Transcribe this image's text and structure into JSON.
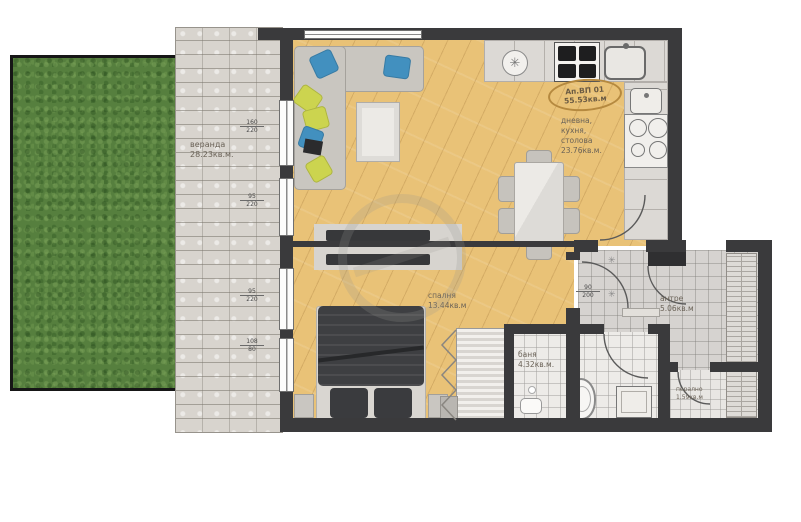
{
  "stamp": {
    "id": "Ап.ВП 01",
    "area": "55.53кв.м"
  },
  "rooms": {
    "veranda": {
      "name": "веранда",
      "area": "28.23кв.м."
    },
    "living": {
      "name1": "дневна,",
      "name2": "кухня,",
      "name3": "столова",
      "area": "23.76кв.м."
    },
    "bedroom": {
      "name": "спалня",
      "area": "13.44кв.м"
    },
    "bathroom": {
      "name": "баня",
      "area": "4.32кв.м."
    },
    "hallway": {
      "name": "антре",
      "area": "5.06кв.м"
    },
    "laundry": {
      "name": "перално",
      "area": "1.59кв.м"
    }
  },
  "dimensions": {
    "window1": {
      "top": "160",
      "bottom": "220"
    },
    "window2": {
      "top": "95",
      "bottom": "220"
    },
    "window3": {
      "top": "95",
      "bottom": "220"
    },
    "window4": {
      "top": "108",
      "bottom": "80"
    },
    "bedroom_door": {
      "top": "90",
      "bottom": "200"
    }
  },
  "icons": {
    "fan": "✳",
    "hook1": "✳",
    "hook2": "✳"
  },
  "colors": {
    "wall": "#3a3a3c",
    "wood_floor": "#e9c277",
    "grass": "#567f3e",
    "paving": "#d8d4ce",
    "stamp_ring": "#b5893f",
    "pillow_blue": "#4290bf",
    "pillow_yellow": "#ccd44f"
  }
}
